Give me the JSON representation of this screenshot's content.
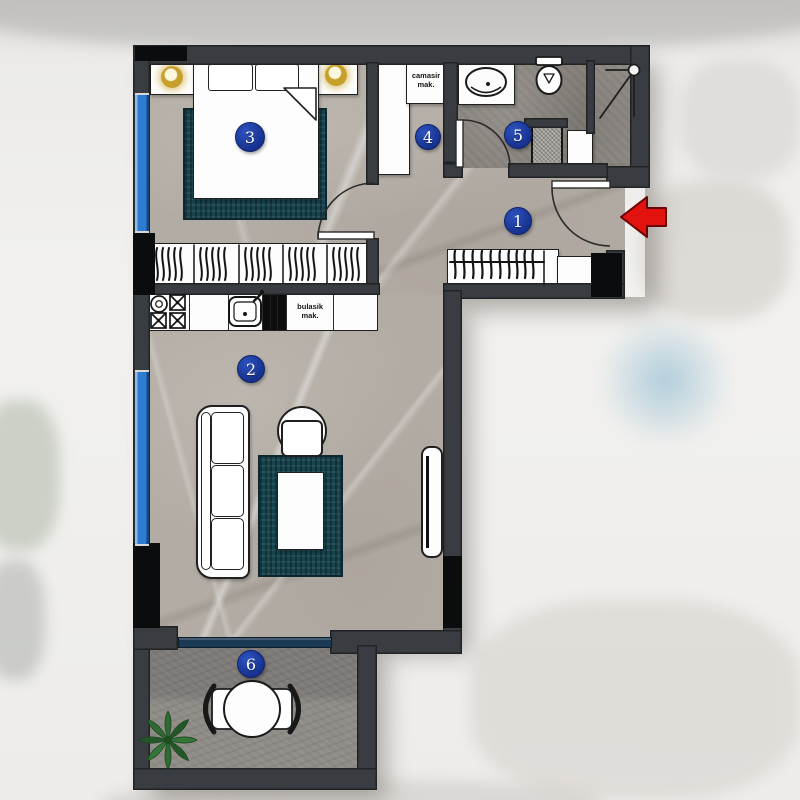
{
  "plan": {
    "type": "apartment-floor-plan",
    "rooms": [
      {
        "number": "1"
      },
      {
        "number": "2"
      },
      {
        "number": "3"
      },
      {
        "number": "4"
      },
      {
        "number": "5"
      },
      {
        "number": "6"
      }
    ],
    "labels": {
      "washing_machine": "camasir mak.",
      "dishwasher": "bulasik mak."
    },
    "colors": {
      "wall": "#393c40",
      "wall_shaft": "#0b0c0d",
      "badge_blue": "#1c3da0",
      "window_blue": "#2e7bd0",
      "balcony_door_blue": "#1d3a55",
      "rug_teal": "#17444f",
      "arrow_red": "#e2130e",
      "floor_main": "#b3aca4",
      "floor_bathroom": "#8b8680",
      "floor_balcony": "#86837f",
      "lamp_gold": "#c7a02c",
      "plant_green": "#2e6a31"
    }
  }
}
